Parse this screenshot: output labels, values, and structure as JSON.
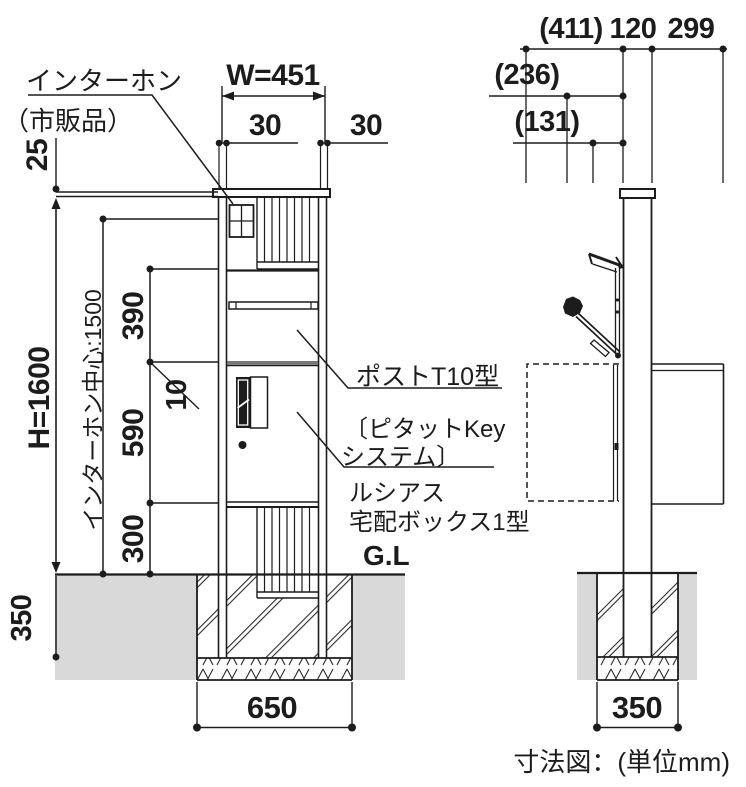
{
  "caption": "寸法図：(単位mm)",
  "front": {
    "intercom_label_1": "インターホン",
    "intercom_label_2": "（市販品）",
    "dim_width": "W=451",
    "dim_offset_left": "30",
    "dim_offset_right": "30",
    "dim_cap_height": "25",
    "dim_total_height": "H=1600",
    "dim_intercom_center": "インターホン中心:1500",
    "dim_section_upper": "390",
    "dim_gap": "10",
    "dim_section_middle": "590",
    "dim_section_lower": "300",
    "dim_embed_depth": "350",
    "dim_footing_width": "650",
    "label_post_type": "ポストT10型",
    "label_key_system_1": "〔ピタットKey",
    "label_key_system_2": "システム〕",
    "label_product_1": "ルシアス",
    "label_product_2": "宅配ボックス1型",
    "label_ground": "G.L"
  },
  "side": {
    "dim_overall_depth": "(411)",
    "dim_post_depth": "120",
    "dim_rear_depth": "299",
    "dim_front_depth": "(236)",
    "dim_inner_depth": "(131)",
    "dim_footing_width": "350"
  },
  "colors": {
    "line": "#1c1c1c",
    "soil": "#d9d9d9",
    "shadow_band": "#777777"
  }
}
